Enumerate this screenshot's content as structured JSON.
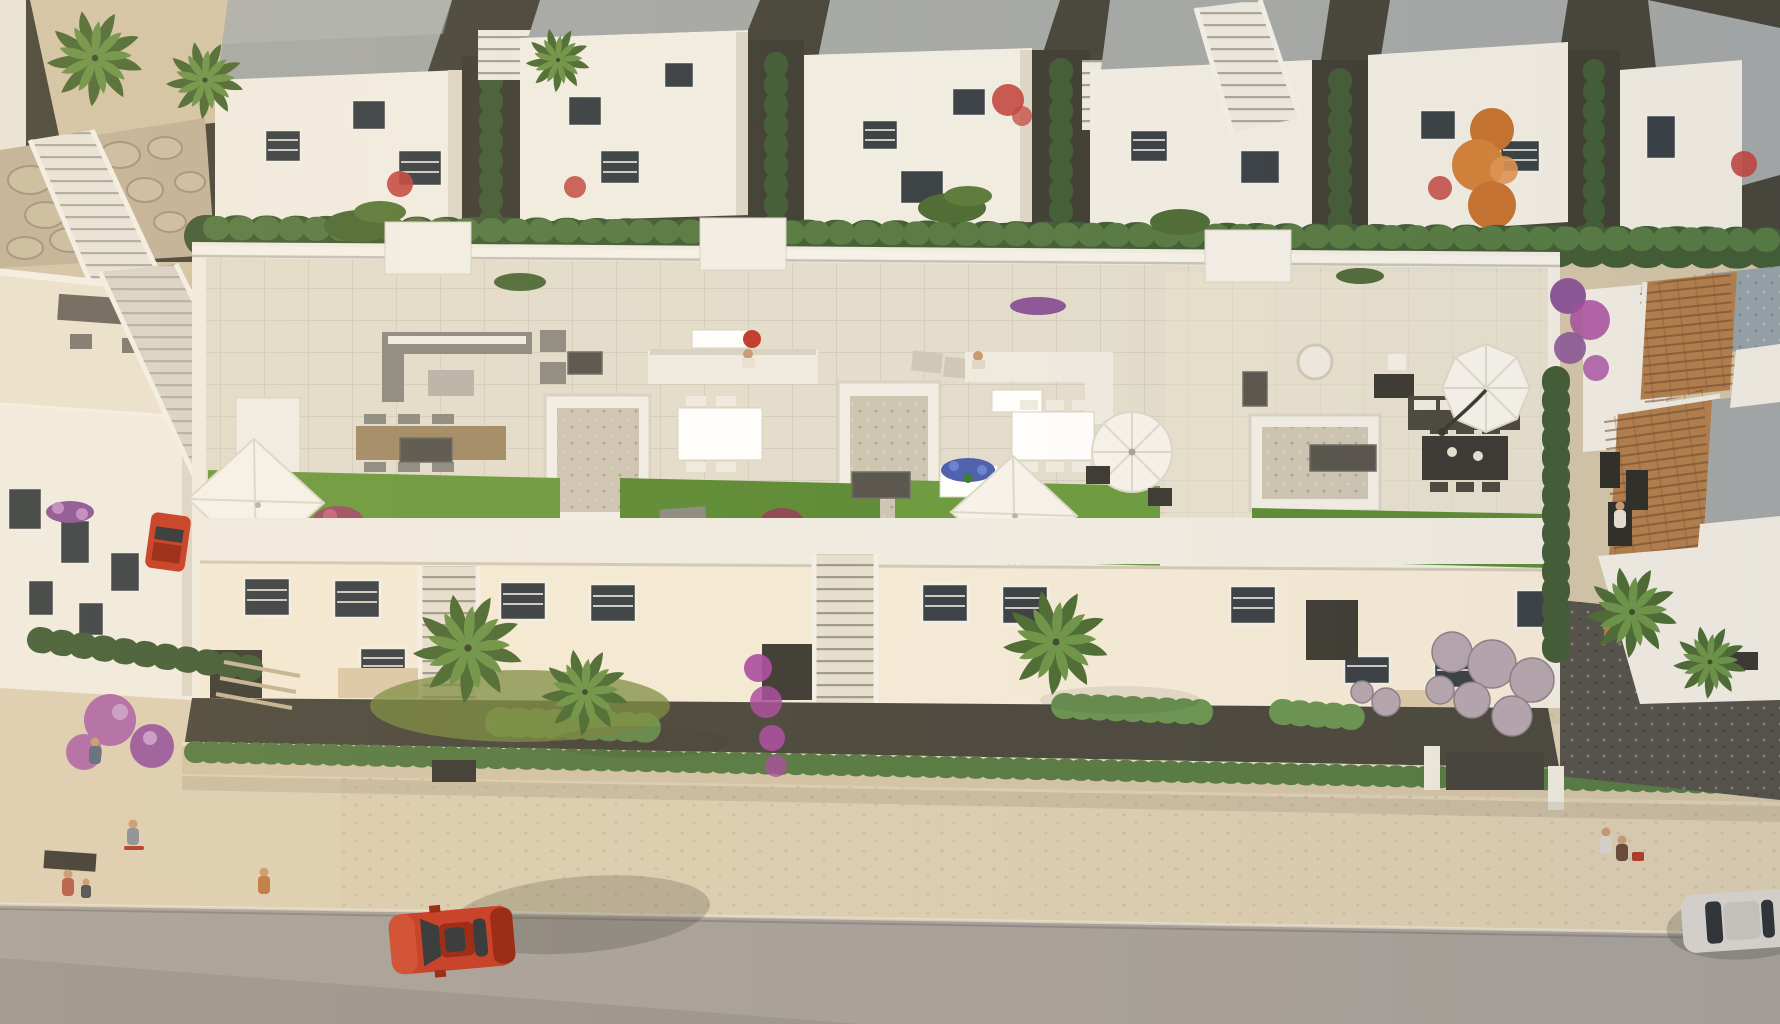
{
  "meta": {
    "type": "3d-architectural-aerial-render",
    "subject": "Bird's-eye view of a white Mediterranean residential development: a row of modern townhouses with furnished rooftop terraces, gardens with palms and hedges, a street with cars and pedestrians",
    "no_text_present": true,
    "lighting": "warm low sun from the left, shadows cast to the right"
  },
  "colors": {
    "path": "#d3c5a8",
    "sidewalk": "#dbcdb1",
    "road": "#a7a09a",
    "roadLower": "#8f8a85",
    "soil": "#4a473d",
    "soilDark": "#3a382f",
    "wallLit": "#f1ede3",
    "wallShade": "#ddd6c7",
    "wallWarm": "#f4ead6",
    "roofGray": "#a5a8a7",
    "roofGrayLight": "#b6b9b7",
    "tile": "#e3ddcd",
    "tileWarm": "#eae2d0",
    "grass": "#6b9a3e",
    "grassDark": "#5c8a35",
    "hedge": "#415c36",
    "hedgeLight": "#567a42",
    "hedgeBright": "#699350",
    "palm": "#6d9448",
    "palmDark": "#4d6b34",
    "stone": "#c2b29a",
    "terracotta": "#b37f4c",
    "terracottaDark": "#8a5c34",
    "umbrella": "#f6f3ec",
    "umbrellaShade": "#ddd8ca",
    "gravelLight": "#cdc5b3",
    "gravelDark": "#55524a",
    "carRed": "#c53a22",
    "carRedDark": "#96230f",
    "carWhite": "#d8d5cf",
    "glass": "#2f3337",
    "flowerPurple": "#8b5596",
    "flowerMagenta": "#a84b9e",
    "flowerPink": "#b06aa8",
    "flowerRed": "#c2453f",
    "autumnOrange": "#c7722e",
    "lavenderBall": "#b5a5ae",
    "skin": "#c89a72",
    "poolDeck": "#97a3a8"
  },
  "scene": {
    "bands": [
      {
        "name": "top-villa-row",
        "desc": "six white two-storey villas with flat gray roofs, dark alleys with cypress hedges, exterior stairs, coral-red shrubs"
      },
      {
        "name": "tall-hedge-row",
        "desc": "continuous dark green hedge separating back row from the main complex"
      },
      {
        "name": "main-complex-roof-terraces",
        "desc": "five rooftop terraces with pale tile floors, white parapets, lounge sets, dining tables, artificial grass strips, gravel patios, AC units and four parasols"
      },
      {
        "name": "main-complex-facades",
        "desc": "street-facing white facades with shuttered windows, recessed porches and two exterior staircases"
      },
      {
        "name": "front-gardens",
        "desc": "dark planting beds with palms, trimmed bright hedges, magenta bougainvillea and lavender gravel balls"
      },
      {
        "name": "street",
        "desc": "beige cobbled sidewalk over a stone wall with low hedge, gray asphalt road"
      }
    ],
    "left_block": {
      "name": "left-apartment-building",
      "desc": "white building with furnished roof deck, purple balcony planter, long diagonal access ramp, small red car parked in the driveway"
    },
    "right_block": {
      "name": "terracotta-roof-house",
      "desc": "white villa with sloped terracotta tile roofs, gray flat roof section, bluish pebble deck, cypress column and bougainvillea"
    },
    "umbrellas": [
      {
        "shape": "square",
        "location": "terrace-1-left"
      },
      {
        "shape": "square",
        "location": "terrace-3-grass"
      },
      {
        "shape": "round",
        "location": "terrace-3-right"
      },
      {
        "shape": "octagonal-cantilever",
        "location": "terrace-4-right"
      }
    ],
    "vehicles": [
      {
        "name": "red-car-driving",
        "color_key": "carRed",
        "location": "road, left of center, heading left"
      },
      {
        "name": "red-car-parked",
        "color_key": "carRed",
        "location": "driveway beside left building"
      },
      {
        "name": "white-car",
        "color_key": "carWhite",
        "location": "road, bottom-right edge, partially cropped"
      }
    ],
    "people": [
      {
        "name": "walker-upper-path",
        "location": "left walkway near stairs"
      },
      {
        "name": "skateboarder",
        "location": "left walkway"
      },
      {
        "name": "adult-and-child",
        "location": "bottom-left sidewalk"
      },
      {
        "name": "walker-orange-shirt",
        "location": "left sidewalk"
      },
      {
        "name": "couple-with-stroller",
        "location": "right sidewalk"
      },
      {
        "name": "person-seated-terrace-2",
        "location": "rooftop sofa"
      },
      {
        "name": "person-seated-terrace-3",
        "location": "rooftop sofa"
      },
      {
        "name": "person-standing-right-terrace",
        "location": "near right house"
      }
    ],
    "vegetation": [
      "fan palms",
      "cypress hedges",
      "banana plants",
      "orange autumn tree",
      "purple flowering trees",
      "pink hydrangeas",
      "coral-red shrubs",
      "boxwood hedges",
      "lavender gravel balls"
    ]
  }
}
